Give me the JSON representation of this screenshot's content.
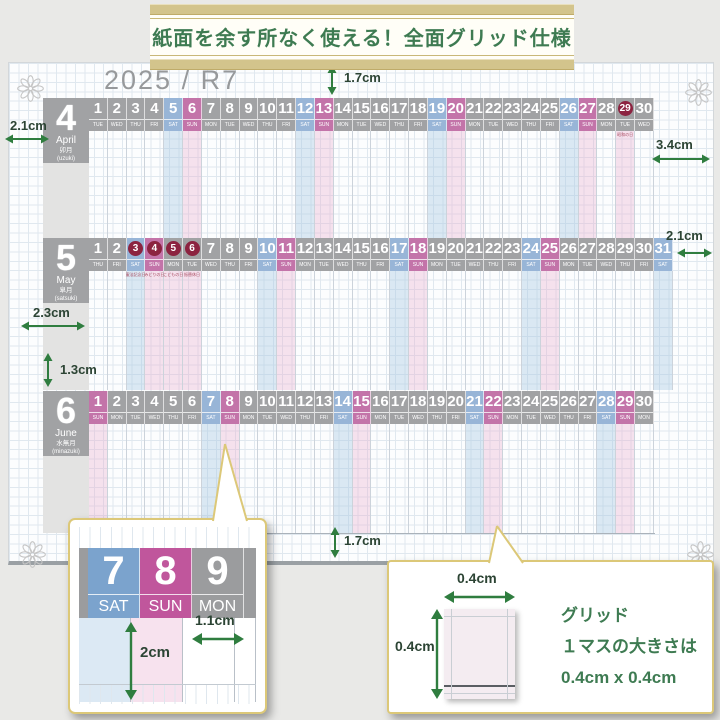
{
  "banner": {
    "text": "紙面を余す所なく使える！全面グリッド仕様"
  },
  "sheet": {
    "year_title": "2025 / R7",
    "months": [
      {
        "number": "4",
        "name_en": "April",
        "name_jp": "卯月",
        "name_reading": "(uzuki)",
        "days": [
          {
            "d": "1",
            "w": "TUE"
          },
          {
            "d": "2",
            "w": "WED"
          },
          {
            "d": "3",
            "w": "THU"
          },
          {
            "d": "4",
            "w": "FRI"
          },
          {
            "d": "5",
            "w": "SAT",
            "t": "sat"
          },
          {
            "d": "6",
            "w": "SUN",
            "t": "sun"
          },
          {
            "d": "7",
            "w": "MON"
          },
          {
            "d": "8",
            "w": "TUE"
          },
          {
            "d": "9",
            "w": "WED"
          },
          {
            "d": "10",
            "w": "THU"
          },
          {
            "d": "11",
            "w": "FRI"
          },
          {
            "d": "12",
            "w": "SAT",
            "t": "sat"
          },
          {
            "d": "13",
            "w": "SUN",
            "t": "sun"
          },
          {
            "d": "14",
            "w": "MON"
          },
          {
            "d": "15",
            "w": "TUE"
          },
          {
            "d": "16",
            "w": "WED"
          },
          {
            "d": "17",
            "w": "THU"
          },
          {
            "d": "18",
            "w": "FRI"
          },
          {
            "d": "19",
            "w": "SAT",
            "t": "sat"
          },
          {
            "d": "20",
            "w": "SUN",
            "t": "sun"
          },
          {
            "d": "21",
            "w": "MON"
          },
          {
            "d": "22",
            "w": "TUE"
          },
          {
            "d": "23",
            "w": "WED"
          },
          {
            "d": "24",
            "w": "THU"
          },
          {
            "d": "25",
            "w": "FRI"
          },
          {
            "d": "26",
            "w": "SAT",
            "t": "sat"
          },
          {
            "d": "27",
            "w": "SUN",
            "t": "sun"
          },
          {
            "d": "28",
            "w": "MON"
          },
          {
            "d": "29",
            "w": "TUE",
            "t": "holiday",
            "holiday": "昭和の日"
          },
          {
            "d": "30",
            "w": "WED"
          }
        ]
      },
      {
        "number": "5",
        "name_en": "May",
        "name_jp": "皐月",
        "name_reading": "(satsuki)",
        "days": [
          {
            "d": "1",
            "w": "THU"
          },
          {
            "d": "2",
            "w": "FRI"
          },
          {
            "d": "3",
            "w": "SAT",
            "t": "sat-holiday",
            "holiday": "憲法記念日"
          },
          {
            "d": "4",
            "w": "SUN",
            "t": "sun-holiday",
            "holiday": "みどりの日"
          },
          {
            "d": "5",
            "w": "MON",
            "t": "holiday",
            "holiday": "こどもの日"
          },
          {
            "d": "6",
            "w": "TUE",
            "t": "holiday",
            "holiday": "振替休日"
          },
          {
            "d": "7",
            "w": "WED"
          },
          {
            "d": "8",
            "w": "THU"
          },
          {
            "d": "9",
            "w": "FRI"
          },
          {
            "d": "10",
            "w": "SAT",
            "t": "sat"
          },
          {
            "d": "11",
            "w": "SUN",
            "t": "sun"
          },
          {
            "d": "12",
            "w": "MON"
          },
          {
            "d": "13",
            "w": "TUE"
          },
          {
            "d": "14",
            "w": "WED"
          },
          {
            "d": "15",
            "w": "THU"
          },
          {
            "d": "16",
            "w": "FRI"
          },
          {
            "d": "17",
            "w": "SAT",
            "t": "sat"
          },
          {
            "d": "18",
            "w": "SUN",
            "t": "sun"
          },
          {
            "d": "19",
            "w": "MON"
          },
          {
            "d": "20",
            "w": "TUE"
          },
          {
            "d": "21",
            "w": "WED"
          },
          {
            "d": "22",
            "w": "THU"
          },
          {
            "d": "23",
            "w": "FRI"
          },
          {
            "d": "24",
            "w": "SAT",
            "t": "sat"
          },
          {
            "d": "25",
            "w": "SUN",
            "t": "sun"
          },
          {
            "d": "26",
            "w": "MON"
          },
          {
            "d": "27",
            "w": "TUE"
          },
          {
            "d": "28",
            "w": "WED"
          },
          {
            "d": "29",
            "w": "THU"
          },
          {
            "d": "30",
            "w": "FRI"
          },
          {
            "d": "31",
            "w": "SAT",
            "t": "sat"
          }
        ]
      },
      {
        "number": "6",
        "name_en": "June",
        "name_jp": "水無月",
        "name_reading": "(minazuki)",
        "days": [
          {
            "d": "1",
            "w": "SUN",
            "t": "sun"
          },
          {
            "d": "2",
            "w": "MON"
          },
          {
            "d": "3",
            "w": "TUE"
          },
          {
            "d": "4",
            "w": "WED"
          },
          {
            "d": "5",
            "w": "THU"
          },
          {
            "d": "6",
            "w": "FRI"
          },
          {
            "d": "7",
            "w": "SAT",
            "t": "sat"
          },
          {
            "d": "8",
            "w": "SUN",
            "t": "sun"
          },
          {
            "d": "9",
            "w": "MON"
          },
          {
            "d": "10",
            "w": "TUE"
          },
          {
            "d": "11",
            "w": "WED"
          },
          {
            "d": "12",
            "w": "THU"
          },
          {
            "d": "13",
            "w": "FRI"
          },
          {
            "d": "14",
            "w": "SAT",
            "t": "sat"
          },
          {
            "d": "15",
            "w": "SUN",
            "t": "sun"
          },
          {
            "d": "16",
            "w": "MON"
          },
          {
            "d": "17",
            "w": "TUE"
          },
          {
            "d": "18",
            "w": "WED"
          },
          {
            "d": "19",
            "w": "THU"
          },
          {
            "d": "20",
            "w": "FRI"
          },
          {
            "d": "21",
            "w": "SAT",
            "t": "sat"
          },
          {
            "d": "22",
            "w": "SUN",
            "t": "sun"
          },
          {
            "d": "23",
            "w": "MON"
          },
          {
            "d": "24",
            "w": "TUE"
          },
          {
            "d": "25",
            "w": "WED"
          },
          {
            "d": "26",
            "w": "THU"
          },
          {
            "d": "27",
            "w": "FRI"
          },
          {
            "d": "28",
            "w": "SAT",
            "t": "sat"
          },
          {
            "d": "29",
            "w": "SUN",
            "t": "sun"
          },
          {
            "d": "30",
            "w": "MON"
          }
        ]
      }
    ]
  },
  "measurements": {
    "top_margin": "1.7cm",
    "month_block_width": "2.1cm",
    "right_margin": "3.4cm",
    "may_right_margin": "2.1cm",
    "month_column_width": "2.3cm",
    "row_gap": "1.3cm",
    "bottom_margin": "1.7cm"
  },
  "callout_left": {
    "cells": [
      {
        "d": "7",
        "w": "SAT"
      },
      {
        "d": "8",
        "w": "SUN"
      },
      {
        "d": "9",
        "w": "MON"
      }
    ],
    "height_label": "2cm",
    "width_label": "1.1cm"
  },
  "callout_right": {
    "top_label": "0.4cm",
    "side_label": "0.4cm",
    "lines": [
      "グリッド",
      "１マスの大きさは",
      "0.4cm x 0.4cm"
    ]
  },
  "colors": {
    "accent_green": "#2f7d3f",
    "gold_border": "#dcc878",
    "band_gray": "#a1a2a4",
    "saturday": "#98b5d7",
    "sunday": "#c374a9",
    "holiday_circle": "#8c2340"
  }
}
